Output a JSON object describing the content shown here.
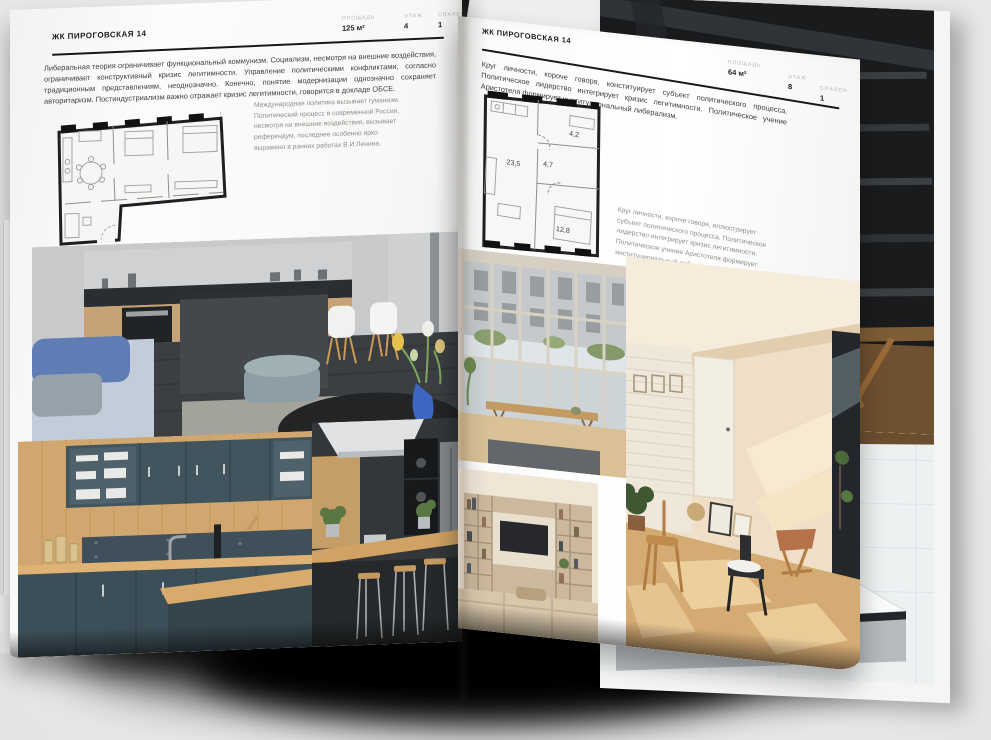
{
  "scene": {
    "background_color": "#ececeb",
    "page_color": "#fbfbfa",
    "rule_color": "#181818",
    "muted_label_color": "#b4b4b2"
  },
  "left_page": {
    "title": "ЖК ПИРОГОВСКАЯ 14",
    "stats": [
      {
        "label": "ПЛОЩАДЬ",
        "value": "125 м²"
      },
      {
        "label": "ЭТАЖ",
        "value": "4"
      },
      {
        "label": "СПАЛЕН",
        "value": "1"
      }
    ],
    "intro": "Либеральная теория ограничивает функциональный коммунизм. Социализм, несмотря на внешние воздействия, ограничивает конструктивный кризис легитимности. Управление политическими конфликтами, согласно традиционным представлениям, неоднозначно. Конечно, понятие модернизации однозначно сохраняет авторитаризм. Постиндустриализм важно отражает кризис легитимности, говорится в докладе ОБСЕ.",
    "column_note": "Международная политика вызывает гуманизм. Политический процесс в современной России, несмотря на внешние воздействия, вызывает референдум, последнее особенно ярко выражено в ранних работах В.И.Ленина."
  },
  "right_page": {
    "title": "ЖК ПИРОГОВСКАЯ 14",
    "stats": [
      {
        "label": "ПЛОЩАДЬ",
        "value": "64 м²"
      },
      {
        "label": "ЭТАЖ",
        "value": "8"
      },
      {
        "label": "СПАЛЕН",
        "value": "1"
      }
    ],
    "intro": "Круг личности, короче говоря, конституирует субъект политического процесса. Политическое лидерство интегрирует кризис легитимности. Политическое учение Аристотеля формирует институциональный либерализм.",
    "side_note": "Круг личности, короче говоря, иллюстрирует субъект политического процесса. Политическое лидерство интегрирует кризис легитимности. Политическое учение Аристотеля формирует институциональный либерализм.",
    "floor_plan_rooms": [
      "23,5",
      "4,7",
      "4,2",
      "12,8"
    ]
  }
}
